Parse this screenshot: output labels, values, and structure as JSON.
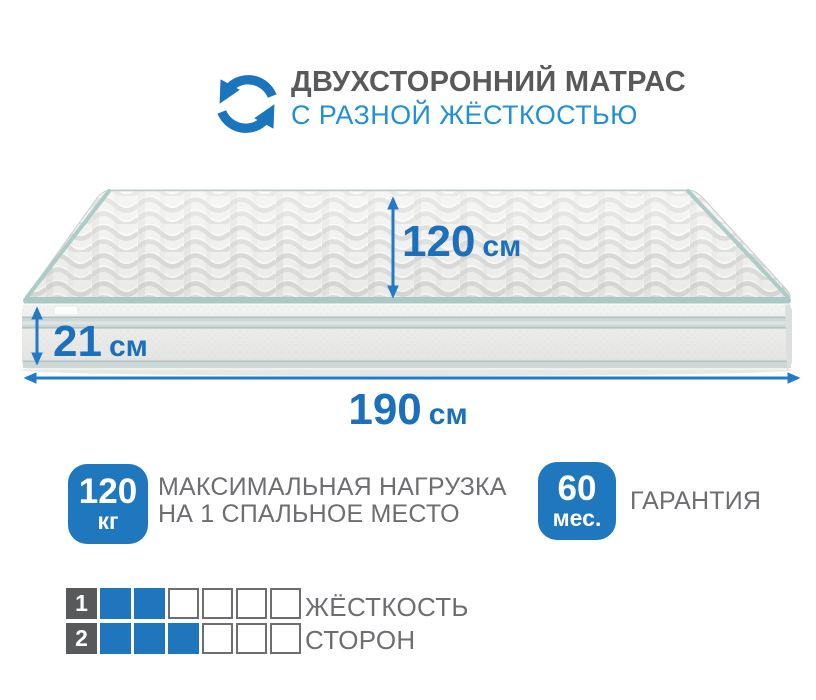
{
  "header": {
    "title": "ДВУХСТОРОННИЙ МАТРАС",
    "subtitle": "С РАЗНОЙ ЖЁСТКОСТЬЮ",
    "icon": "rotate-arrows-icon"
  },
  "colors": {
    "primary_blue": "#1c6fba",
    "azure_blue": "#2191d7",
    "badge_blue": "#1f78bd",
    "square_blue": "#2076bc",
    "dark_gray": "#58595b",
    "text_gray": "#6d6e71",
    "piping_teal": "#aac9c6"
  },
  "mattress": {
    "dimensions": {
      "depth": {
        "value": "120",
        "unit": "см"
      },
      "height": {
        "value": "21",
        "unit": "см"
      },
      "length": {
        "value": "190",
        "unit": "см"
      }
    }
  },
  "features": [
    {
      "badge_value": "120",
      "badge_unit": "кг",
      "label_line1": "МАКСИМАЛЬНАЯ НАГРУЗКА",
      "label_line2": "НА 1 СПАЛЬНОЕ МЕСТО"
    },
    {
      "badge_value": "60",
      "badge_unit": "мес.",
      "label_line1": "ГАРАНТИЯ",
      "label_line2": ""
    }
  ],
  "firmness": {
    "label_line1": "ЖЁСТКОСТЬ",
    "label_line2": "СТОРОН",
    "scale_max": 6,
    "rows": [
      {
        "side": "1",
        "filled": 2
      },
      {
        "side": "2",
        "filled": 3
      }
    ]
  }
}
